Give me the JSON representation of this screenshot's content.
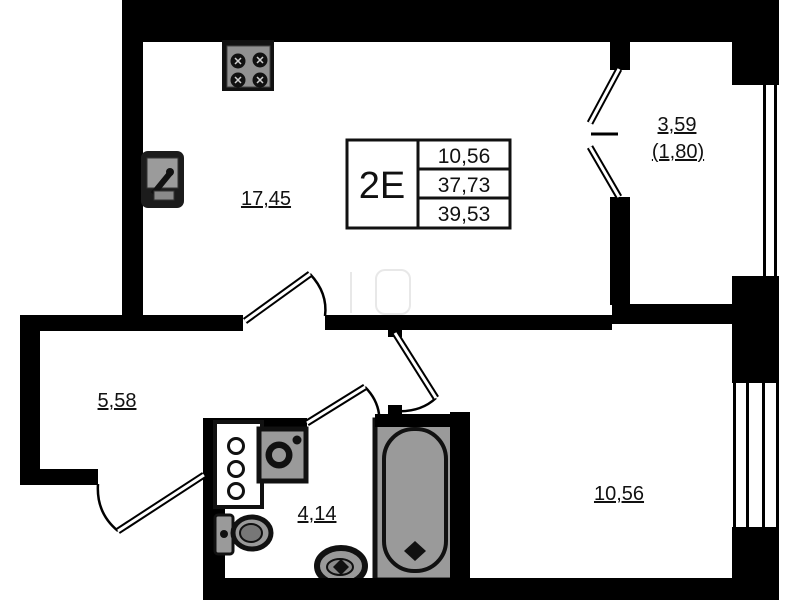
{
  "plan": {
    "info_box": {
      "type": "2E",
      "rows": [
        "10,56",
        "37,73",
        "39,53"
      ]
    },
    "rooms": {
      "kitchen_living": "17,45",
      "hallway": "5,58",
      "bathroom": "4,14",
      "bedroom": "10,56",
      "balcony": "3,59",
      "balcony_reduced": "(1,80)"
    },
    "colors": {
      "wall": "#000000",
      "fixture_gray": "#9a9a9a",
      "background": "#ffffff"
    }
  }
}
